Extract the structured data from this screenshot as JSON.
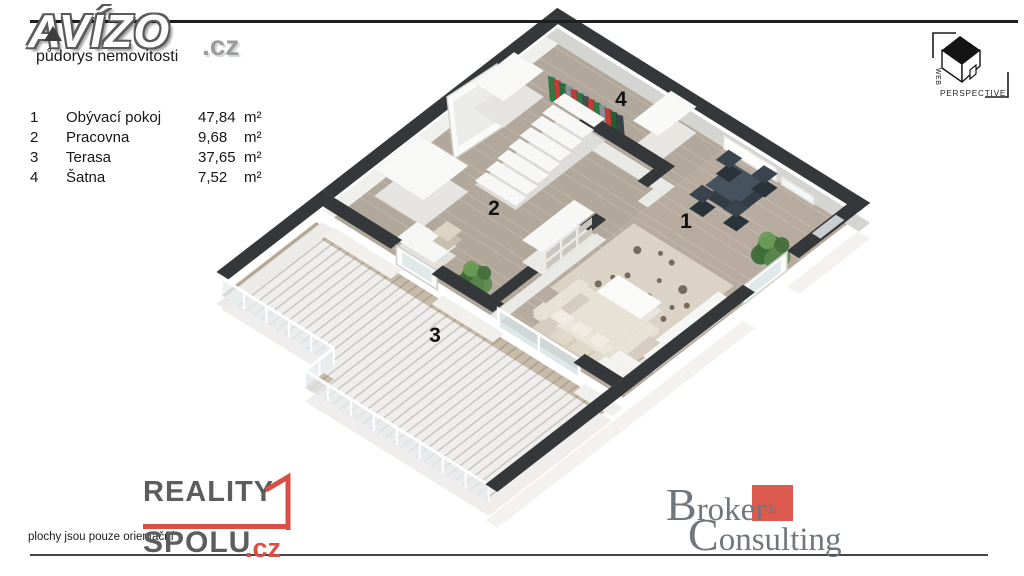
{
  "header": {
    "brand": "AVÍZO",
    "brand_suffix": ".cz",
    "subtitle": "půdorys nemovitosti"
  },
  "legend": {
    "rows": [
      {
        "num": "1",
        "name": "Obývací pokoj",
        "value": "47,84",
        "unit": "m²"
      },
      {
        "num": "2",
        "name": "Pracovna",
        "value": "9,68",
        "unit": "m²"
      },
      {
        "num": "3",
        "name": "Terasa",
        "value": "37,65",
        "unit": "m²"
      },
      {
        "num": "4",
        "name": "Šatna",
        "value": "7,52",
        "unit": "m²"
      }
    ]
  },
  "watermark": {
    "vertical": "WEB",
    "horizontal": "PERSPECTIVE"
  },
  "footer": {
    "disclaimer": "plochy jsou pouze orientační",
    "reality": "REALITY",
    "spolu": "SPOLU",
    "cz": ".cz",
    "broker_initial": "B",
    "broker_rest": "roker",
    "broker_reg": "®",
    "consulting_initial": "C",
    "consulting_rest": "onsulting"
  },
  "colors": {
    "accent_red": "#d94f45",
    "broker_red": "#dd5a4e",
    "broker_gray": "#70767c",
    "wall_top": "#34383b",
    "floor_wood": "#b4aa9d",
    "deck_wood": "#c6baa8",
    "line_dark": "#1f1f1f"
  },
  "floorplan": {
    "origin": [
      558,
      44
    ],
    "axis": [
      0.85,
      0.53,
      -0.8,
      0.62
    ],
    "wall_top": "#34383b",
    "room_labels": [
      {
        "text": "1",
        "at": [
          686,
          228
        ]
      },
      {
        "text": "2",
        "at": [
          494,
          215
        ]
      },
      {
        "text": "3",
        "at": [
          435,
          342
        ]
      },
      {
        "text": "4",
        "at": [
          621,
          106
        ]
      }
    ],
    "scene": [
      {
        "t": "floor",
        "rect": [
          0,
          0,
          196,
          280
        ],
        "fill": "#b1a79a",
        "step": 9
      },
      {
        "t": "floor",
        "rect": [
          196,
          0,
          340,
          280
        ],
        "fill": "#b6ab9e",
        "step": 9
      },
      {
        "t": "rug",
        "rect": [
          200,
          118,
          318,
          222
        ],
        "fill": "#dad3c6",
        "spots": [
          [
            225,
            140,
            4
          ],
          [
            258,
            132,
            3
          ],
          [
            288,
            150,
            4.5
          ],
          [
            240,
            168,
            3
          ],
          [
            272,
            176,
            4
          ],
          [
            300,
            187,
            3
          ],
          [
            228,
            192,
            3.5
          ],
          [
            252,
            202,
            4
          ],
          [
            285,
            207,
            3
          ],
          [
            243,
            130,
            2.5
          ],
          [
            304,
            162,
            3
          ],
          [
            265,
            155,
            2.5
          ],
          [
            232,
            178,
            2.5
          ],
          [
            296,
            172,
            2.5
          ]
        ]
      },
      {
        "t": "deck",
        "poly": [
          [
            -8,
            294
          ],
          [
            -8,
            412
          ],
          [
            124,
            412
          ],
          [
            124,
            448
          ],
          [
            340,
            448
          ],
          [
            340,
            294
          ]
        ],
        "fill": "#c6baa8",
        "step": 9
      },
      {
        "t": "wall",
        "rect": [
          -14,
          -14,
          354,
          0
        ],
        "side": "#d4d4d1",
        "drop": 0
      },
      {
        "t": "wall",
        "rect": [
          -14,
          0,
          0,
          280
        ],
        "side": "#efefec",
        "drop": 0
      },
      {
        "t": "wall",
        "rect": [
          -14,
          280,
          0,
          412
        ],
        "side": "#ecebe8",
        "drop": 12
      },
      {
        "t": "panel",
        "a": [
          196,
          1
        ],
        "b": [
          258,
          1
        ],
        "h": 13,
        "fill": "#fdfdfc",
        "stroke": "#e2e2de"
      },
      {
        "t": "panel",
        "a": [
          264,
          1
        ],
        "b": [
          302,
          1
        ],
        "h": 8,
        "fill": "#f4f6f6",
        "stroke": "#e2e2de"
      },
      {
        "t": "mirror",
        "pts": [
          [
            447,
            97
          ],
          [
            497,
            64
          ],
          [
            504,
            126
          ],
          [
            454,
            159
          ]
        ],
        "inner": [
          [
            453,
            102
          ],
          [
            495,
            74
          ],
          [
            500,
            120
          ],
          [
            458,
            147
          ]
        ]
      },
      {
        "t": "box",
        "rect": [
          0,
          55,
          35,
          105
        ],
        "h": 26,
        "top": "#f8f8f6",
        "side": "#e5e4e0"
      },
      {
        "t": "clothes",
        "a": [
          552,
          76
        ],
        "b": [
          620,
          114
        ],
        "drop": 27,
        "colors": [
          "#2e7a43",
          "#c23b35",
          "#2a6d3b",
          "#8b9095",
          "#c23b35",
          "#2e7a43",
          "#454d54",
          "#c23b35",
          "#2e7a43",
          "#8b9095",
          "#c23b35",
          "#235e33",
          "#3a4249"
        ]
      },
      {
        "t": "box",
        "rect": [
          135,
          2,
          165,
          50
        ],
        "h": 26,
        "top": "#f9f9f7",
        "side": "#e7e6e2"
      },
      {
        "t": "wall",
        "rect": [
          95,
          62,
          196,
          76
        ],
        "side": "#e9e9e6",
        "drop": 0
      },
      {
        "t": "wall",
        "rect": [
          184,
          76,
          196,
          96
        ],
        "side": "#e9e9e6",
        "drop": 0
      },
      {
        "t": "wall",
        "rect": [
          184,
          148,
          196,
          280
        ],
        "side": "#e9e9e6",
        "drop": 0
      },
      {
        "t": "stairs",
        "x1": 64,
        "x2": 112,
        "y0": 60,
        "n": 8,
        "step": 14,
        "h0": 22,
        "dh": 2.6,
        "top": "#f7f7f5",
        "side": "#dedcd8"
      },
      {
        "t": "box",
        "rect": [
          8,
          182,
          66,
          238
        ],
        "h": 26,
        "top": "#f8f8f6",
        "side": "#e5e4e0"
      },
      {
        "t": "shelf",
        "rect": [
          160,
          150,
          184,
          215
        ],
        "h": 22,
        "top": "#f7f7f5",
        "side": "#eceae6",
        "cubby": "#c8c6c1"
      },
      {
        "t": "box",
        "rect": [
          66,
          246,
          112,
          274
        ],
        "h": 10,
        "top": "#f6f6f4",
        "side": "#e2e1dd"
      },
      {
        "t": "box",
        "rect": [
          84,
          228,
          102,
          246
        ],
        "h": 9,
        "top": "#ddd3c4",
        "side": "#c9bfae"
      },
      {
        "t": "plant",
        "at": [
          148,
          262
        ],
        "s": 1
      },
      {
        "t": "box",
        "rect": [
          225,
          20,
          262,
          55
        ],
        "h": 12,
        "top": "#46525d",
        "side": "#333d46"
      },
      {
        "t": "box",
        "rect": [
          212,
          12,
          228,
          28
        ],
        "h": 14,
        "top": "#3a444f",
        "side": "#2a323a"
      },
      {
        "t": "box",
        "rect": [
          248,
          6,
          264,
          22
        ],
        "h": 14,
        "top": "#3a444f",
        "side": "#2a323a"
      },
      {
        "t": "box",
        "rect": [
          224,
          58,
          240,
          74
        ],
        "h": 14,
        "top": "#3a444f",
        "side": "#2a323a"
      },
      {
        "t": "box",
        "rect": [
          258,
          52,
          274,
          68
        ],
        "h": 14,
        "top": "#3a444f",
        "side": "#2a323a"
      },
      {
        "t": "box",
        "rect": [
          320,
          140,
          338,
          240
        ],
        "h": 9,
        "top": "#f6f6f4",
        "side": "#e2e1dd"
      },
      {
        "t": "plant",
        "at": [
          318,
          72
        ],
        "s": 1.1
      },
      {
        "t": "box",
        "rect": [
          240,
          180,
          292,
          210
        ],
        "h": 8,
        "top": "#fafaf8",
        "side": "#e6e5e1"
      },
      {
        "t": "box",
        "rect": [
          222,
          210,
          318,
          268
        ],
        "h": 11,
        "top": "#e8e2d6",
        "side": "#d5cdbf"
      },
      {
        "t": "box",
        "rect": [
          222,
          254,
          318,
          268
        ],
        "h": 17,
        "top": "#ece6da",
        "side": "#d5cdbf"
      },
      {
        "t": "box",
        "rect": [
          222,
          210,
          236,
          268
        ],
        "h": 14,
        "top": "#e8e2d6",
        "side": "#d5cdbf"
      },
      {
        "t": "box",
        "rect": [
          304,
          210,
          318,
          268
        ],
        "h": 14,
        "top": "#e8e2d6",
        "side": "#d5cdbf"
      },
      {
        "t": "box",
        "rect": [
          240,
          252,
          258,
          266
        ],
        "h": 19,
        "top": "#f1ece1",
        "side": "#e0d9ca"
      },
      {
        "t": "box",
        "rect": [
          262,
          252,
          280,
          266
        ],
        "h": 19,
        "top": "#f1ece1",
        "side": "#e0d9ca"
      },
      {
        "t": "box",
        "rect": [
          284,
          252,
          300,
          266
        ],
        "h": 19,
        "top": "#f1ece1",
        "side": "#e0d9ca"
      },
      {
        "t": "box",
        "rect": [
          306,
          248,
          334,
          276
        ],
        "h": 10,
        "top": "#f4f3f0",
        "side": "#e0dfdb"
      },
      {
        "t": "box",
        "rect": [
          306,
          266,
          334,
          276
        ],
        "h": 15,
        "top": "#f4f3f0",
        "side": "#e0dfdb"
      },
      {
        "t": "wall",
        "rect": [
          0,
          280,
          80,
          294
        ],
        "side": "#f1f0ed",
        "drop": 10
      },
      {
        "t": "panel",
        "a": [
          80,
          287
        ],
        "b": [
          128,
          287
        ],
        "h": 19,
        "fill": "#fbfbfa",
        "stroke": "#cfcfcb",
        "glass": true
      },
      {
        "t": "wall",
        "rect": [
          128,
          280,
          200,
          294
        ],
        "side": "#f1f0ed",
        "drop": 10
      },
      {
        "t": "glassdoor",
        "a": [
          200,
          287
        ],
        "b": [
          295,
          287
        ],
        "h": 19
      },
      {
        "t": "wall",
        "rect": [
          295,
          280,
          340,
          294
        ],
        "side": "#f1f0ed",
        "drop": 10
      },
      {
        "t": "rail",
        "pts": [
          [
            -8,
            412
          ],
          [
            124,
            412
          ],
          [
            124,
            448
          ],
          [
            340,
            448
          ]
        ],
        "h": 17
      },
      {
        "t": "wall",
        "rect": [
          340,
          -14,
          354,
          75
        ],
        "side": "#f3f2ef",
        "drop": 16
      },
      {
        "t": "wintop",
        "rect": [
          342,
          16,
          352,
          46
        ],
        "fill": "#c9ced2"
      },
      {
        "t": "panel",
        "a": [
          340,
          75
        ],
        "b": [
          340,
          130
        ],
        "h": 19,
        "fill": "#fcfcfb",
        "stroke": "#cfcfcb",
        "glass": true
      },
      {
        "t": "wall",
        "rect": [
          340,
          130,
          354,
          452
        ],
        "side": "#f3f2ef",
        "drop": 16
      }
    ]
  }
}
